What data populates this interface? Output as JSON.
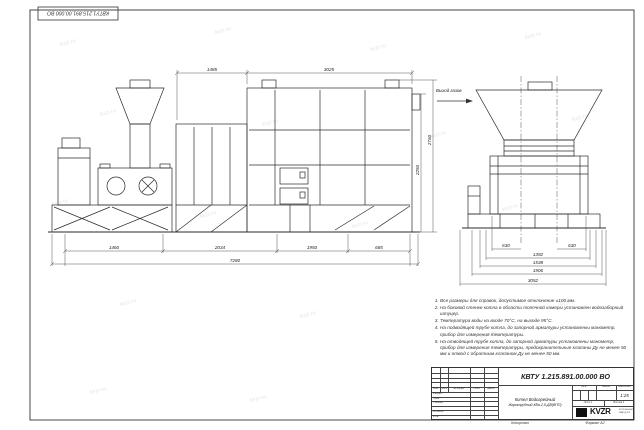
{
  "sheet": {
    "stamp_code": "КВТУ1.215.891.00.000 ВО",
    "watermark_text": "kvzr.ru"
  },
  "labels": {
    "gas_outlet": "Выход газов"
  },
  "dims": {
    "top_left": "1485",
    "top_right": "3025",
    "bottom": [
      "1460",
      "2034",
      "1950",
      "685"
    ],
    "overall": "7280",
    "height_inner": "2250",
    "height_outer": "2760",
    "side": [
      "630",
      "630",
      "1392",
      "1538",
      "1906",
      "3052"
    ]
  },
  "notes": {
    "items": [
      "Все размеры для справок, допустимое отклонение ±100 мм.",
      "На боковой стенке котла в области топочной камеры установлен водозаборный штуцер.",
      "Температура воды на входе 70°С, на выходе 95°С.",
      "На подводящей трубе котла, до запорной арматуры установлены манометр, прибор для измерения температуры.",
      "На отводящей трубе котла, до запорной арматуры установлены манометр, прибор для измерения температуры, предохранительные клапаны Ду не менее 50 мм и отвод с обратным клапаном Ду не менее 50 мм."
    ]
  },
  "title_block": {
    "doc_number": "КВТУ 1.215.891.00.000 ВО",
    "product_name_1": "Котел Водогрейный",
    "product_name_2": "Жаротрубный КВа-2,5-ДВ(ВПП)",
    "header_cols": {
      "izm": "Изм.",
      "list": "Лист",
      "doc": "№ докум.",
      "podp": "Подп.",
      "data": "Дата"
    },
    "rows": {
      "razrab": "Разраб.",
      "prov": "Пров.",
      "tkontr": "Т.контр.",
      "nkontr": "Н.контр.",
      "utv": "Утв."
    },
    "lit": "Лит.",
    "massa": "Масса",
    "masshtab": "Масштаб",
    "scale": "1:25",
    "list_cell": "Лист 1",
    "listov_cell": "Листов 1",
    "logo": "KVZR",
    "logo_sub1": "КОТЕЛЬНЫЙ",
    "logo_sub2": "ЗАВОД РФ",
    "kopiroval": "Копировал",
    "format": "Формат А2"
  }
}
